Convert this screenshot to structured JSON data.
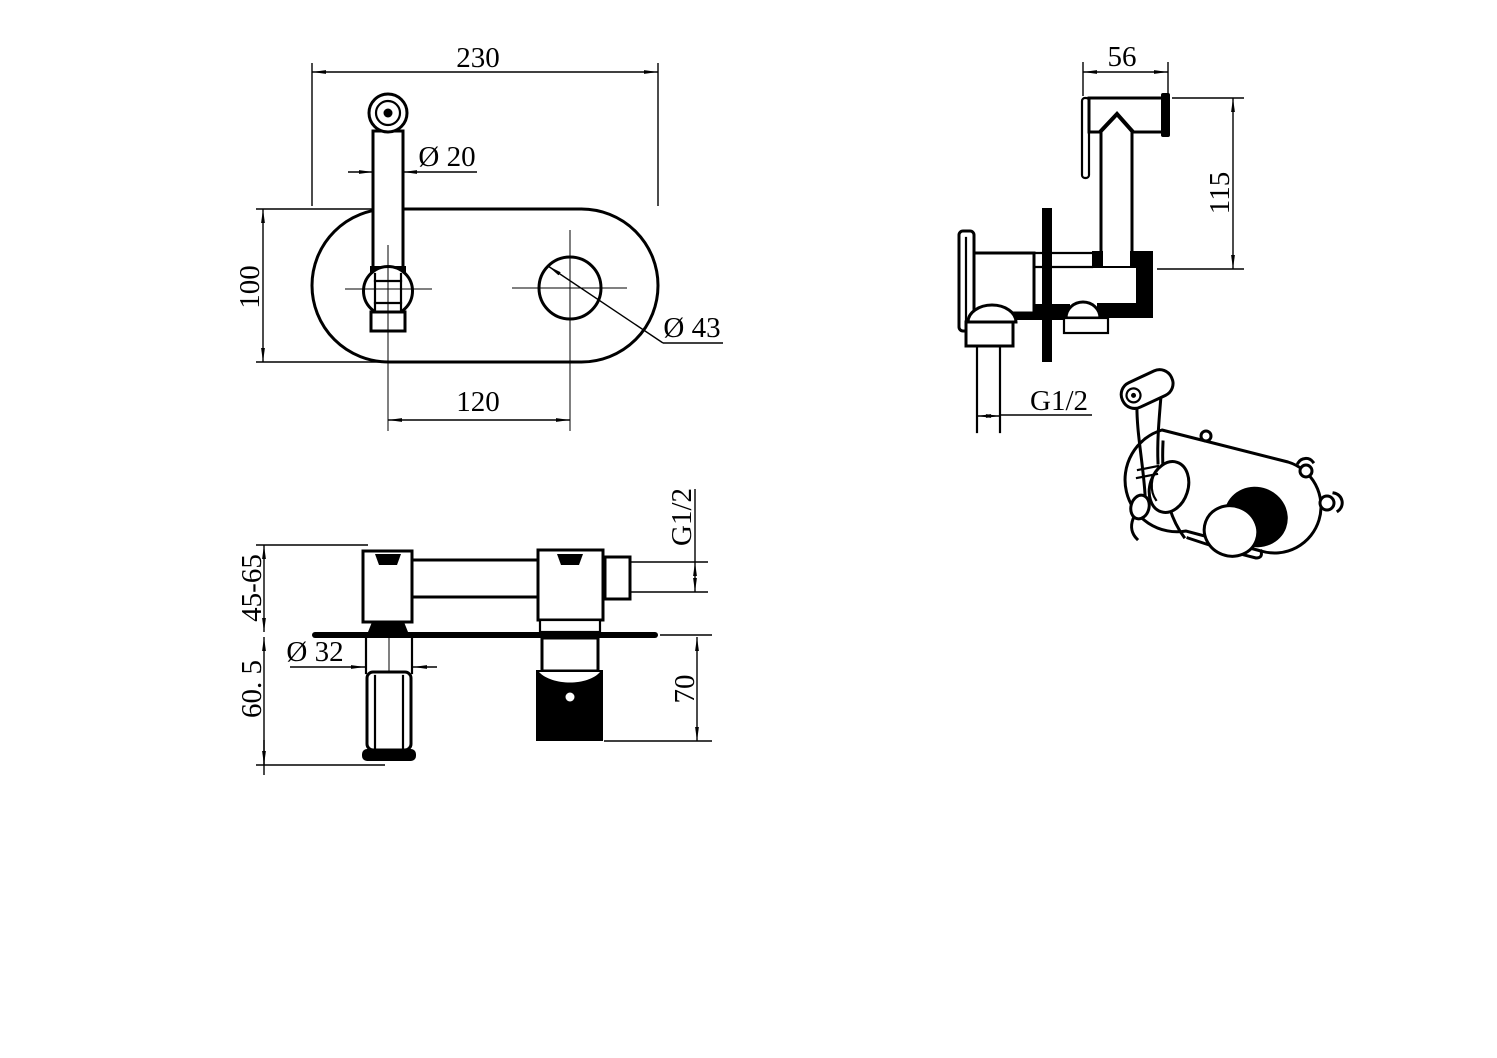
{
  "drawing": {
    "colors": {
      "line": "#000000",
      "background": "#ffffff"
    },
    "front_view": {
      "width_label": "230",
      "spout_dia_label": "Ø 20",
      "height_label": "100",
      "spacing_label": "120",
      "hole_dia_label": "Ø 43"
    },
    "side_view": {
      "head_width_label": "56",
      "height_label": "115",
      "thread_label": "G1/2"
    },
    "section_view": {
      "thread_label": "G1/2",
      "depth_range_label": "45-65",
      "lower_depth_label": "60. 5",
      "handle_dia_label": "Ø 32",
      "valve_height_label": "70"
    }
  }
}
